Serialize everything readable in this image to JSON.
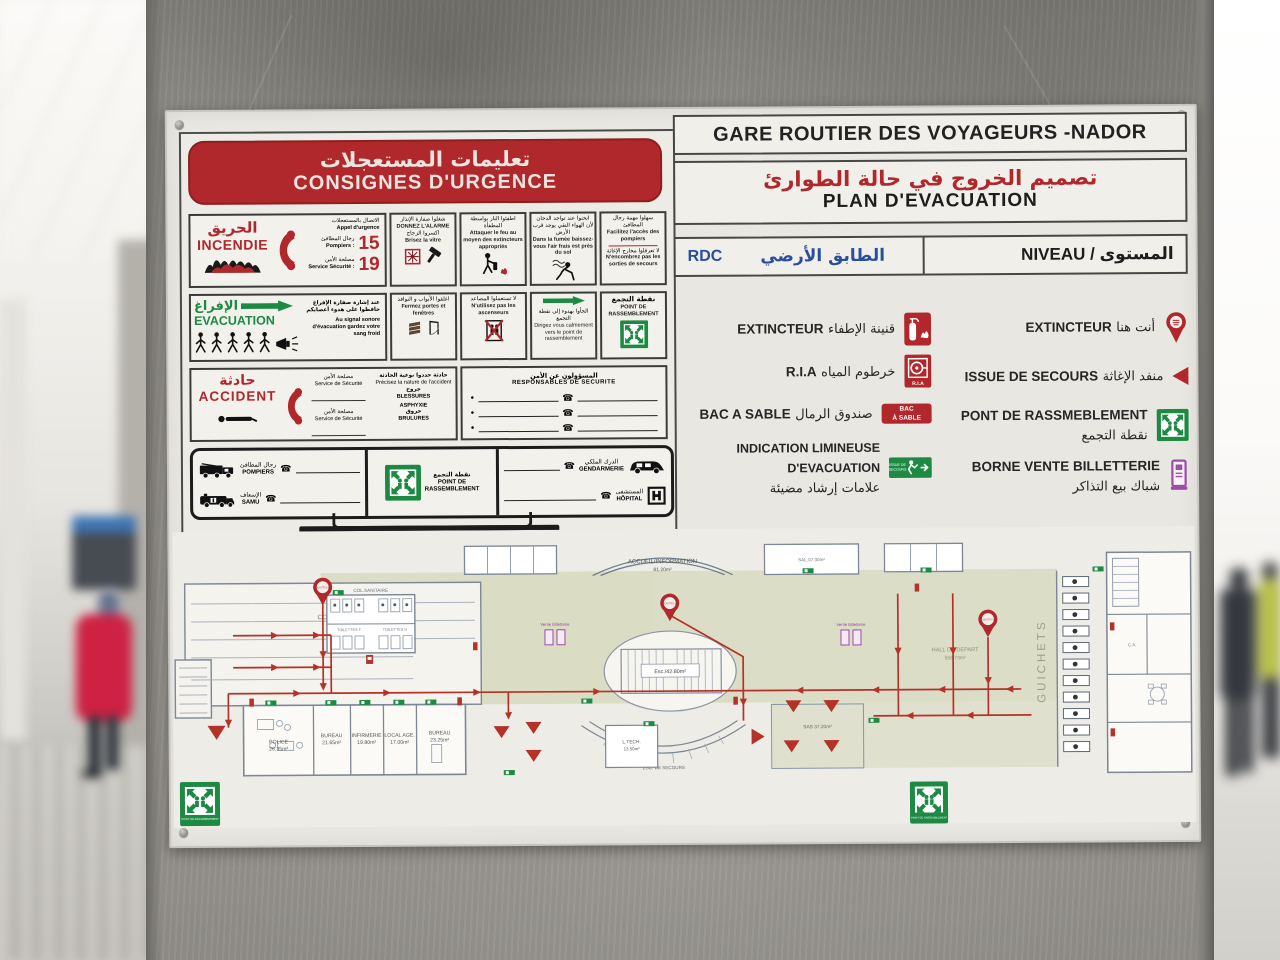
{
  "colors": {
    "red": "#b0272c",
    "green": "#1d8a44",
    "blue": "#2a4e9e",
    "purple": "#9c4da5",
    "pillar": "#97948e",
    "sign_bg": "#e9e7e1"
  },
  "sign": {
    "title": "GARE ROUTIER DES VOYAGEURS -NADOR",
    "evac_ar": "تصميم الخروج في حالة الطوارئ",
    "evac_fr": "PLAN D'EVACUATION",
    "level": {
      "code": "RDC",
      "ar": "الطابق الأرضي",
      "fr": "NIVEAU /",
      "fr_ar": "المستوى"
    }
  },
  "consignes": {
    "banner_ar": "تعليمات المستعجلات",
    "banner_fr": "CONSIGNES D'URGENCE",
    "incendie": {
      "ar": "الحريق",
      "fr": "INCENDIE",
      "call_ar": "الاتصال بالمستعجلات",
      "call_fr": "Appel d'urgence",
      "rows": [
        {
          "ar": "رجال المطافئ",
          "fr": "Pompiers :",
          "num": "15"
        },
        {
          "ar": "مصلحة الأمن",
          "fr": "Service Sécurité :",
          "num": "19"
        }
      ]
    },
    "cells_a": [
      {
        "ar": "شغلوا صفارة الإنذار",
        "fr": "DONNEZ L'ALARME",
        "ar2": "اكسروا الزجاج",
        "fr2": "Brisez la vitre"
      },
      {
        "ar": "اطفئوا النار بواسطة المطفأة",
        "fr": "Attaquer le feu au moyen des extincteurs appropriés"
      },
      {
        "ar": "انحنوا عند تواجد الدخان لأن الهواء النقي يوجد قرب الأرض",
        "fr": "Dans la fumée baissez-vous l'air frais est près du sol"
      },
      {
        "ar": "سهلوا مهمة رجال المطافئ",
        "fr": "Facilitez l'accès des pompiers",
        "ar2": "لا تعرقلوا مخارج الإغاثة",
        "fr2": "N'encombrez pas les sorties de secours"
      }
    ],
    "evacuation": {
      "ar": "الإفراغ",
      "fr": "EVACUATION",
      "note_ar": "عند إشارة صفارة الإفراغ حافظوا على هدوء أعصابكم",
      "note_fr": "Au signal sonore d'évacuation gardez votre sang froid"
    },
    "cells_b": [
      {
        "ar": "اغلقوا الأبواب و النوافذ",
        "fr": "Fermez portes et fenêtres"
      },
      {
        "ar": "لا تستعملوا المصاعد",
        "fr": "N'utilisez pas les ascenseurs"
      },
      {
        "ar": "الجأوا بهدوء إلى نقطة التجمع",
        "fr": "Dirigez vous calmement vers le point de rassemblement"
      },
      {
        "ar": "نقطة التجمع",
        "fr": "POINT DE RASSEMBLEMENT"
      }
    ],
    "accident": {
      "ar": "حادثة",
      "fr": "ACCIDENT",
      "security_ar": "مصلحة الأمن",
      "security_fr": "Service de Sécurité",
      "nature_ar": "حادثة حددوا نوعية الحادثة",
      "nature_fr": "Précisez la nature de l'accident",
      "types": [
        {
          "ar": "جروح",
          "fr": "BLESSURES"
        },
        {
          "ar": "",
          "fr": "ASPHYXIE"
        },
        {
          "ar": "حروق",
          "fr": "BRULURES"
        }
      ]
    },
    "responsables": {
      "ar": "المسؤولون عن الأمن",
      "fr": "RESPONSABLES DE SECURITE"
    },
    "services": {
      "pompiers_ar": "رجال المطافئ",
      "pompiers_fr": "POMPIERS",
      "samu_ar": "الإسعاف",
      "samu_fr": "SAMU",
      "point_ar": "نقطة التجمع",
      "point_fr1": "POINT DE",
      "point_fr2": "RASSEMBLEMENT",
      "gendarmerie_ar": "الدرك الملكي",
      "gendarmerie_fr": "GENDARMERIE",
      "hopital_ar": "المستشفى",
      "hopital_fr": "HÔPITAL"
    }
  },
  "legend": {
    "left": [
      {
        "fr": "EXTINCTEUR",
        "ar": "قنينة الإطفاء"
      },
      {
        "fr": "R.I.A",
        "ar": "خرطوم المياه",
        "icon_label": "R.I.A"
      },
      {
        "fr": "BAC A SABLE",
        "ar": "صندوق الرمال",
        "badge1": "BAC",
        "badge2": "À SABLE"
      },
      {
        "fr": "INDICATION LIMINEUSE D'EVACUATION",
        "ar": "علامات إرشاد مضيئة",
        "icon_line1": "ISSUE DE",
        "icon_line2": "SECOURS"
      }
    ],
    "right": [
      {
        "fr": "EXTINCTEUR",
        "ar": "أنت هنا"
      },
      {
        "fr": "ISSUE DE SECOURS",
        "ar": "منفد الإغاثة"
      },
      {
        "fr": "PONT DE RASSMEBLEMENT",
        "ar": "نقطة التجمع"
      },
      {
        "fr": "BORNE VENTE BILLETTERIE",
        "ar": "شباك بيع التذاكر"
      }
    ]
  },
  "plan": {
    "consigne": "CONSIGNE",
    "col_sanitaire": "COL.SANITAIRE",
    "toilettes_f": "TOILETTES F",
    "toilettes_h": "TOILETTES H",
    "accueil": "ACCUEIL/INFORMATION",
    "accueil_area": "81.20m²",
    "sal_top": "SAL.07.30m²",
    "esc": "Esc./42.80m²",
    "esc_secours": "ESC. DE SECOURS",
    "l_tech": "L.TECH.",
    "l_tech_area": "13.50m²",
    "sas": "SAS 37.20m²",
    "hall_depart": "HALL DE DEPART",
    "hall_depart_area": "556.73m²",
    "guichets": "GUICHETS",
    "vente": "Vente Billetterie",
    "ca": "C.A.",
    "rooms": [
      {
        "name": "POLICE",
        "area": "26.35m²"
      },
      {
        "name": "BUREAU",
        "area": "21.65m²"
      },
      {
        "name": "INFIRMERIE",
        "area": "19.80m²"
      },
      {
        "name": "LOCAL AGE.",
        "area": "17.00m²"
      },
      {
        "name": "BUREAU",
        "area": "23.25m²"
      }
    ],
    "vous_etes_ici": "VOUS ÊTES ICI",
    "point_rassemblement": "POINT DE RASSEMBLEMENT"
  }
}
